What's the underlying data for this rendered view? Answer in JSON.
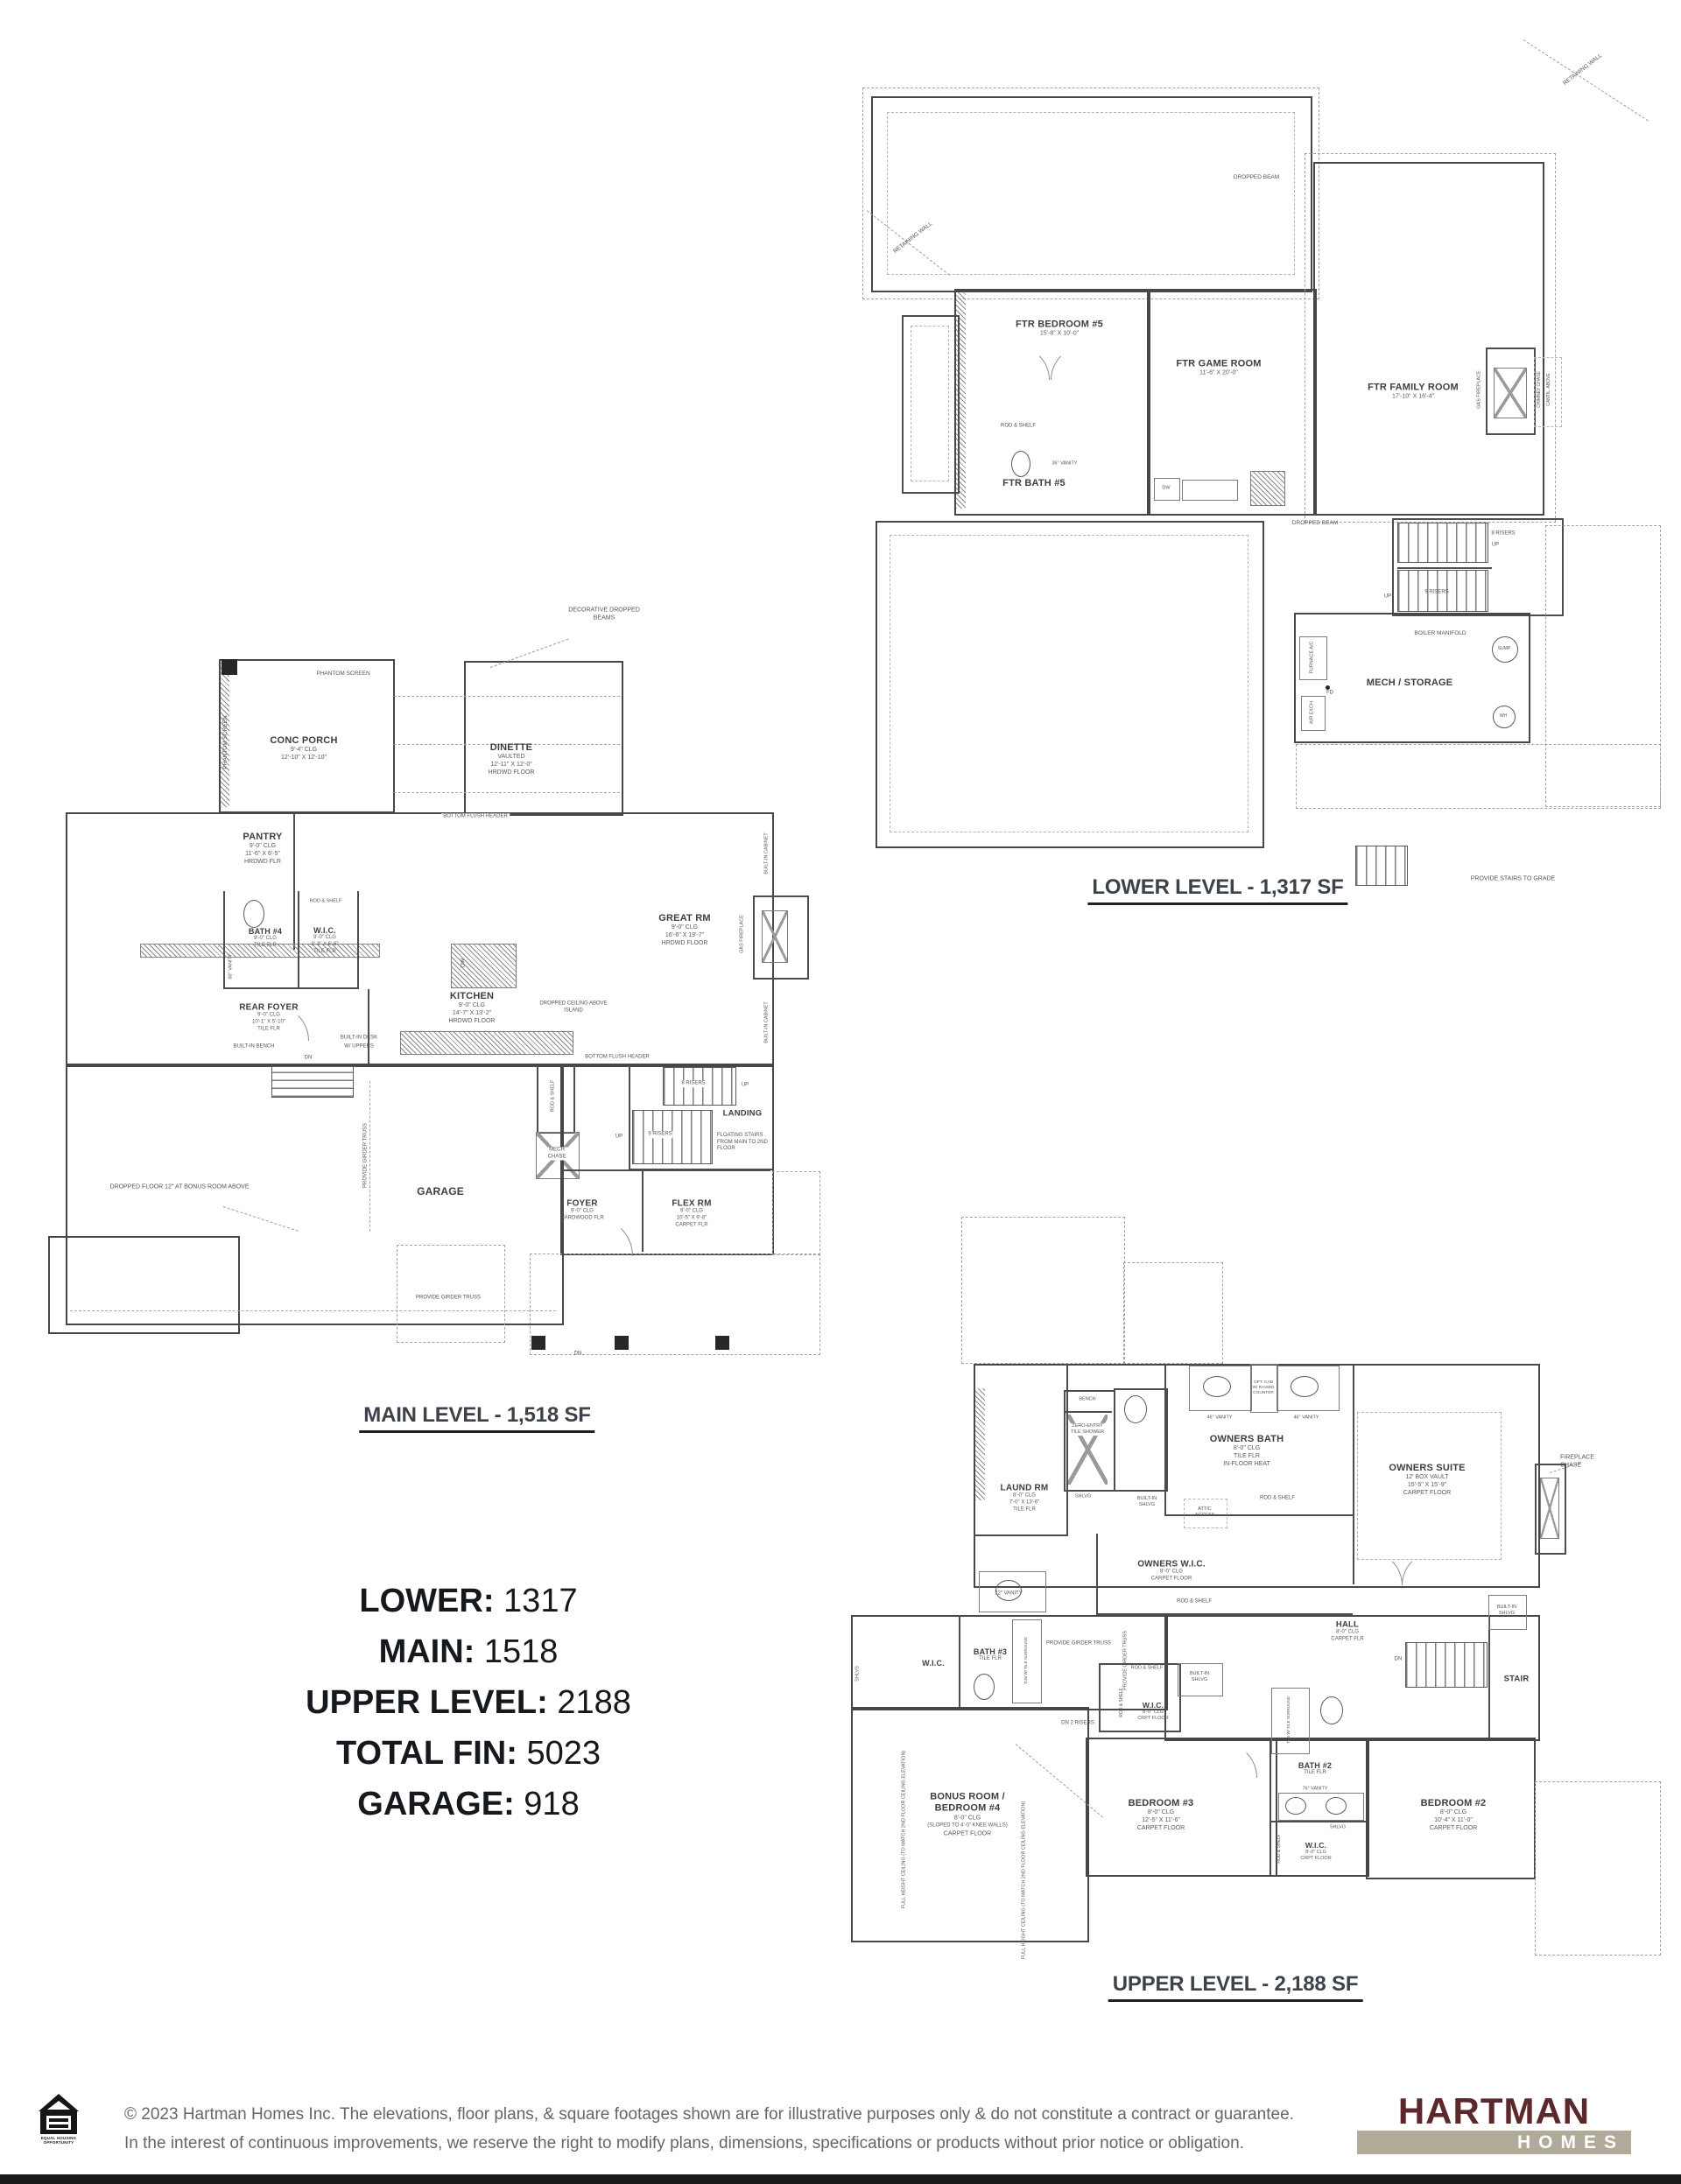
{
  "titles": {
    "lower": "LOWER LEVEL - 1,317 SF",
    "main": "MAIN LEVEL - 1,518 SF",
    "upper": "UPPER LEVEL - 2,188 SF"
  },
  "summary": {
    "rows": [
      {
        "label": "LOWER:",
        "value": "1317"
      },
      {
        "label": "MAIN:",
        "value": "1518"
      },
      {
        "label": "UPPER LEVEL:",
        "value": "2188"
      },
      {
        "label": "TOTAL FIN:",
        "value": "5023"
      },
      {
        "label": "GARAGE:",
        "value": "918"
      }
    ]
  },
  "lower": {
    "rooms": [
      {
        "name": "FTR BEDROOM #5",
        "l1": "15'-8\" X 10'-0\""
      },
      {
        "name": "FTR GAME ROOM",
        "l1": "11'-6\" X 20'-0\""
      },
      {
        "name": "FTR FAMILY ROOM",
        "l1": "17'-10\" X 16'-4\""
      },
      {
        "name": "FTR BATH #5"
      },
      {
        "name": "MECH / STORAGE"
      }
    ],
    "ann": {
      "retaining1": "RETAINING WALL",
      "retaining2": "RETAINING WALL",
      "dropped1": "DROPPED BEAM",
      "dropped2": "DROPPED BEAM",
      "risers8": "8 RISERS",
      "up1": "UP",
      "risers9": "9 RISERS",
      "up2": "UP",
      "boiler": "BOILER MANIFOLD",
      "furnace": "FURNACE A/C",
      "fd": "FD",
      "airexch": "AIR EXCH",
      "sump": "SUMP",
      "wh": "WH",
      "stairs_grade": "PROVIDE STAIRS TO GRADE",
      "gasfp": "GAS FIREPLACE",
      "chimney": "CHIMNEY CHASE",
      "cantil": "CANTIL. ABOVE",
      "rodshelf": "ROD & SHELF",
      "vanity36": "36\" VANITY",
      "dw": "DW"
    }
  },
  "main": {
    "rooms": [
      {
        "name": "CONC PORCH",
        "l1": "9'-4\" CLG",
        "l2": "12'-10\" X 12'-10\""
      },
      {
        "name": "DINETTE",
        "l1": "VAULTED",
        "l2": "12'-11\" X 12'-0\"",
        "l3": "HRDWD FLOOR"
      },
      {
        "name": "PANTRY",
        "l1": "9'-0\" CLG",
        "l2": "11'-6\" X 6'-5\"",
        "l3": "HRDWD FLR"
      },
      {
        "name": "BATH #4",
        "l1": "9'-0\" CLG",
        "l2": "TILE FLR"
      },
      {
        "name": "W.I.C.",
        "l1": "9'-0\" CLG",
        "l2": "3'-3\" X 6'-6\"",
        "l3": "TILE FLR"
      },
      {
        "name": "REAR FOYER",
        "l1": "9'-0\" CLG",
        "l2": "10'-1\" X 5'-10\"",
        "l3": "TILE FLR"
      },
      {
        "name": "KITCHEN",
        "l1": "9'-0\" CLG",
        "l2": "14'-7\" X 13'-2\"",
        "l3": "HRDWD FLOOR"
      },
      {
        "name": "GREAT RM",
        "l1": "9'-0\" CLG",
        "l2": "16'-6\" X 19'-7\"",
        "l3": "HRDWD FLOOR"
      },
      {
        "name": "GARAGE"
      },
      {
        "name": "FOYER",
        "l1": "9'-0\" CLG",
        "l2": "HARDWOOD FLR"
      },
      {
        "name": "FLEX RM",
        "l1": "9'-0\" CLG",
        "l2": "10'-5\" X 9'-8\"",
        "l3": "CARPET FLR"
      },
      {
        "name": "LANDING"
      }
    ],
    "ann": {
      "phantom1": "PHANTOM SCREEN",
      "phantom2": "PHANTOM SCREEN",
      "decor": "DECORATIVE DROPPED BEAMS",
      "bfh1": "BOTTOM FLUSH HEADER",
      "bfh2": "BOTTOM FLUSH HEADER",
      "rodshelf_wic": "ROD & SHELF",
      "bench": "BUILT-IN BENCH",
      "dn1": "DN",
      "desk": "BUILT-IN DESK",
      "desk2": "W/ UPPERS",
      "dropceil": "DROPPED CEILING ABOVE ISLAND",
      "dw": "DW",
      "gasfp": "GAS FIREPLACE",
      "cab1": "BUILT-IN CABINET",
      "cab2": "BUILT-IN CABINET",
      "risers8": "8 RISERS",
      "up1": "UP",
      "risers9": "9 RISERS",
      "up2": "UP",
      "floating": "FLOATING STAIRS FROM MAIN TO 2ND FLOOR",
      "rodshelf2": "ROD & SHELF",
      "mech": "MECH CHASE",
      "girder1": "PROVIDE GIRDER TRUSS",
      "girder2": "PROVIDE GIRDER TRUSS",
      "dropfloor": "DROPPED FLOOR 12\" AT BONUS ROOM ABOVE",
      "dn2": "DN",
      "vanity60": "60\" VANITY"
    }
  },
  "upper": {
    "rooms": [
      {
        "name": "LAUND RM",
        "l1": "8'-0\" CLG",
        "l2": "7'-0\" X 13'-6\"",
        "l3": "TILE FLR"
      },
      {
        "name": "OWNERS BATH",
        "l1": "8'-0\" CLG",
        "l2": "TILE FLR",
        "l3": "IN-FLOOR HEAT"
      },
      {
        "name": "OWNERS W.I.C.",
        "l1": "8'-0\" CLG",
        "l2": "CARPET FLOOR"
      },
      {
        "name": "OWNERS SUITE",
        "l1": "12' BOX VAULT",
        "l2": "15'-5\" X 15'-9\"",
        "l3": "CARPET FLOOR"
      },
      {
        "name": "HALL",
        "l1": "8'-0\" CLG",
        "l2": "CARPET FLR"
      },
      {
        "name": "W.I.C."
      },
      {
        "name": "BATH #3",
        "l1": "TILE FLR"
      },
      {
        "name": "BONUS ROOM / BEDROOM #4",
        "l1": "8'-0\" CLG",
        "l2": "(SLOPED TO 4'-0\" KNEE WALLS)",
        "l3": "CARPET FLOOR"
      },
      {
        "name": "BEDROOM #3",
        "l1": "8'-0\" CLG",
        "l2": "12'-5\" X 11'-6\"",
        "l3": "CARPET FLOOR"
      },
      {
        "name": "W.I.C.",
        "l1": "8'-0\" CLG",
        "l2": "CRPT FLOOR"
      },
      {
        "name": "BATH #2",
        "l1": "TILE FLR"
      },
      {
        "name": "W.I.C.",
        "l1": "8'-0\" CLG",
        "l2": "CRPT FLOOR"
      },
      {
        "name": "BEDROOM #2",
        "l1": "8'-0\" CLG",
        "l2": "10'-4\" X 11'-0\"",
        "l3": "CARPET FLOOR"
      },
      {
        "name": "STAIR"
      }
    ],
    "ann": {
      "bench": "BENCH",
      "shower": "ZERO-ENTRY TILE SHOWER",
      "shlvg1": "SHLVG",
      "bishlvg1": "BUILT-IN SHLVG",
      "vanity46a": "46\" VANITY",
      "vanity46b": "46\" VANITY",
      "optcab": "OPT. CAB W/ RAISED COUNTER",
      "attic": "ATTIC ACCESS",
      "rodshelf1": "ROD & SHELF",
      "rodshelf2": "ROD & SHELF",
      "vanity72": "72\" VANITY",
      "fpchase": "FIREPLACE CHASE",
      "bishlvg2": "BUILT-IN SHLVG",
      "dn1": "DN",
      "shlvs": "SHLVS",
      "girder1": "PROVIDE GIRDER TRUSS",
      "girder2": "PROVIDE GIRDER TRUSS",
      "dn2risers": "DN 2 RISERS",
      "rodshelf3": "ROD & SHELF",
      "rodshelf4": "ROD & SHELF",
      "bishlvg3": "BUILT-IN SHLVG",
      "fullheight1": "FULL HEIGHT CEILING (TO MATCH 2ND FLOOR CEILING ELEVATION)",
      "fullheight2": "FULL HEIGHT CEILING (TO MATCH 2ND FLOOR CEILING ELEVATION)",
      "shlvg2": "SHLVG",
      "rodshelf5": "ROD & SHELF",
      "vanity76": "76\" VANITY",
      "tub1": "TUB W/ TILE SURROUND",
      "tub2": "TUB W/ TILE SURROUND"
    }
  },
  "footer": {
    "line1": "© 2023 Hartman Homes Inc. The elevations, floor plans, & square footages shown are for illustrative purposes only & do not constitute a contract or guarantee.",
    "line2": "In the interest of continuous improvements, we reserve the right to modify plans, dimensions, specifications or products without prior notice or obligation.",
    "eho_line1": "EQUAL HOUSING",
    "eho_line2": "OPPORTUNITY",
    "logo_top": "HARTMAN",
    "logo_bottom": "HOMES",
    "brand_maroon": "#5c282b",
    "brand_taupe": "#b1aa99"
  }
}
